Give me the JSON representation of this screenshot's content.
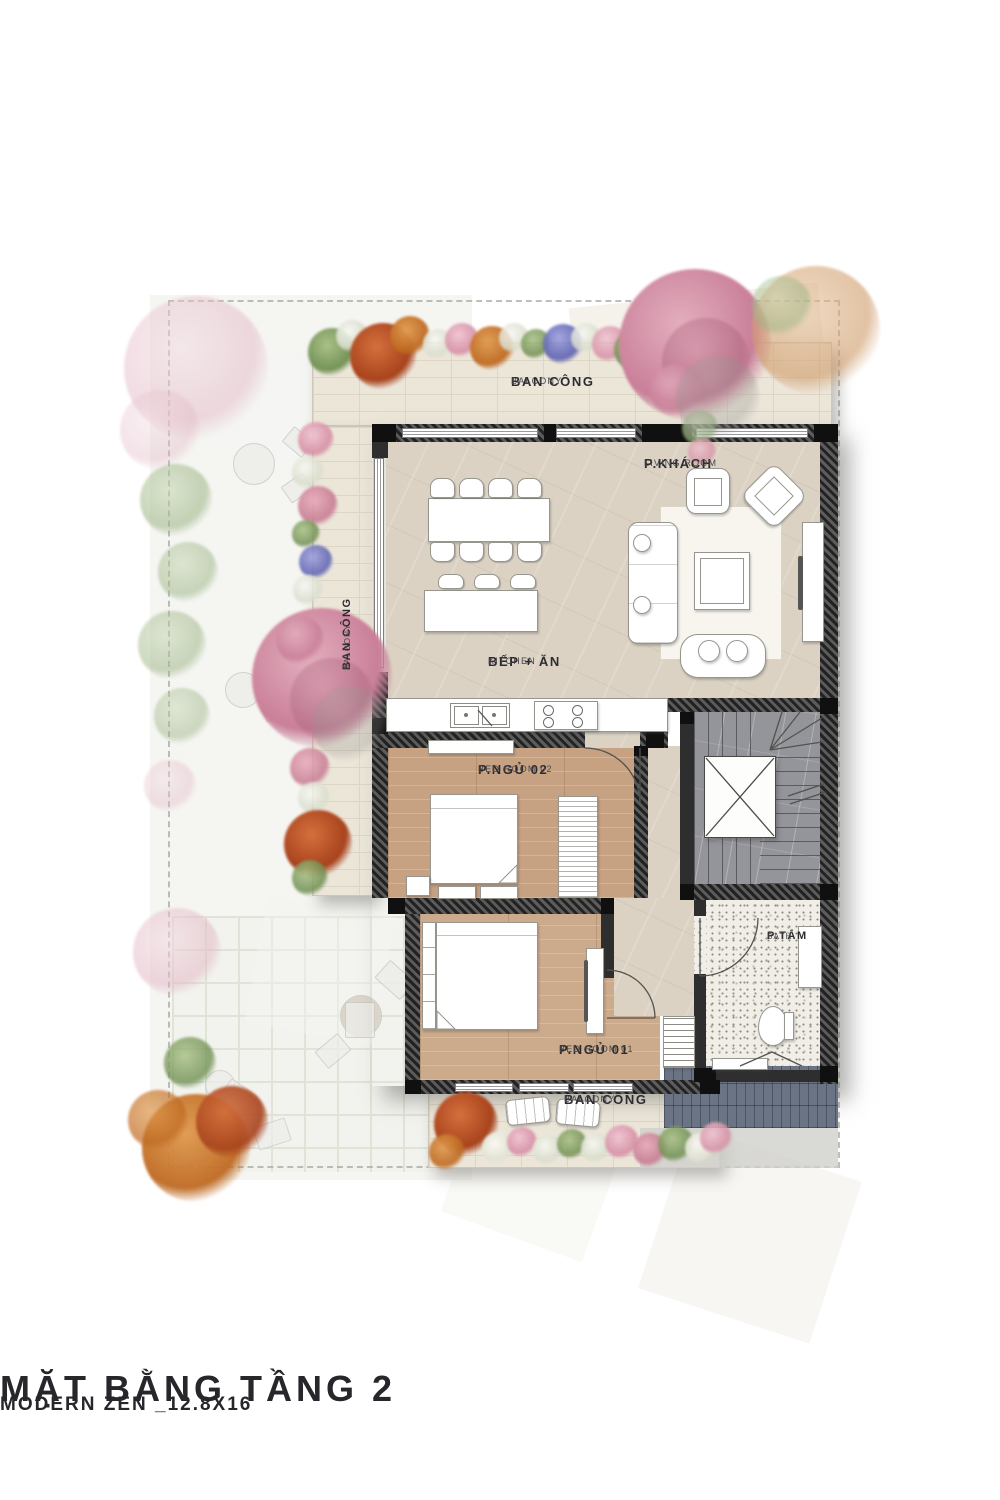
{
  "title": {
    "main": "MẶT BẰNG TẦNG 2",
    "sub": "MODERN ZEN _12.8X16"
  },
  "labels": {
    "balcony_top": {
      "vi": "BAN CÔNG",
      "en": "BALCONY"
    },
    "living_room": {
      "vi": "P.KHÁCH",
      "en": "LIVING ROOM"
    },
    "kitchen": {
      "vi": "BẾP + ĂN",
      "en": "KITCHEN"
    },
    "bedroom_02": {
      "vi": "P.NGỦ 02",
      "en": "BED ROOM 02"
    },
    "bathroom": {
      "vi": "P.TẮM",
      "en": "BATH"
    },
    "bedroom_01": {
      "vi": "P.NGỦ 01",
      "en": "BED ROOM 01"
    },
    "balcony_bottom": {
      "vi": "BAN CÔNG",
      "en": "BALCONY"
    },
    "balcony_left": {
      "vi": "BAN CÔNG",
      "en": "BALCONY"
    }
  },
  "colors": {
    "floor_marble": "#dbd2c3",
    "floor_wood": "#c6a283",
    "floor_wood_light": "#ccab8d",
    "floor_stone": "#ece6d9",
    "floor_stair": "#94959a",
    "floor_terrazzo": "#f1eee8",
    "roof_slate": "#6b7484",
    "wall_dark": "#2b2b2b",
    "accent_pink": "#d493a8",
    "accent_orange": "#c2542b",
    "accent_green": "#87a468",
    "accent_purple": "#6f74c4",
    "text_dark": "#2c2c30"
  }
}
